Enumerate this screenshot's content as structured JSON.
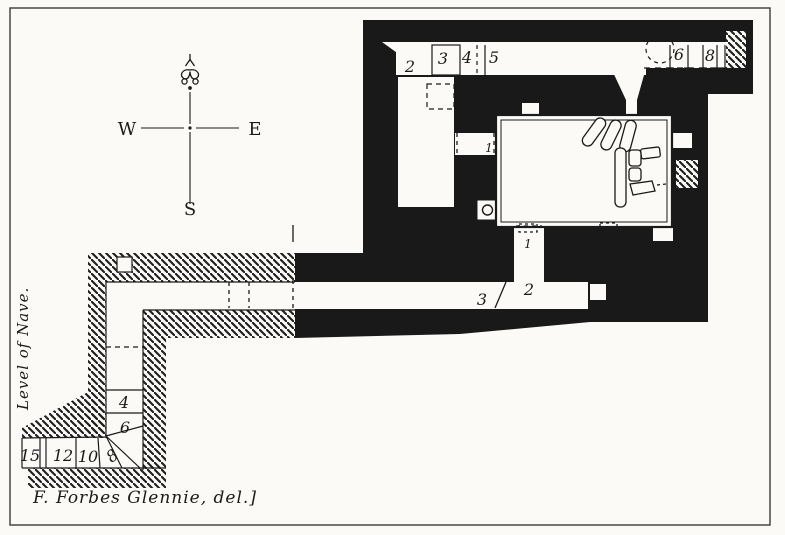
{
  "compass": {
    "west": "W",
    "east": "E",
    "south": "S",
    "north_icon": "fleur-de-lis"
  },
  "labels": {
    "upper_corridor_2": "2",
    "upper_bay_3": "3",
    "upper_bay_4": "4",
    "upper_bay_5": "5",
    "upper_bay_6": "6",
    "upper_bay_8": "8",
    "west_passage_1": "1",
    "south_passage_1": "1",
    "mid_corridor_2": "2",
    "mid_corridor_3": "3",
    "stair_step_4": "4",
    "stair_step_6": "6",
    "stair_step_8": "8",
    "stair_step_10": "10",
    "stair_step_12": "12",
    "stair_step_15": "15"
  },
  "notes": {
    "side": "Level of Nave.",
    "caption": "F. Forbes Glennie, del.]"
  },
  "colors": {
    "ink": "#1a1a1a",
    "paper": "#fbfaf6"
  }
}
